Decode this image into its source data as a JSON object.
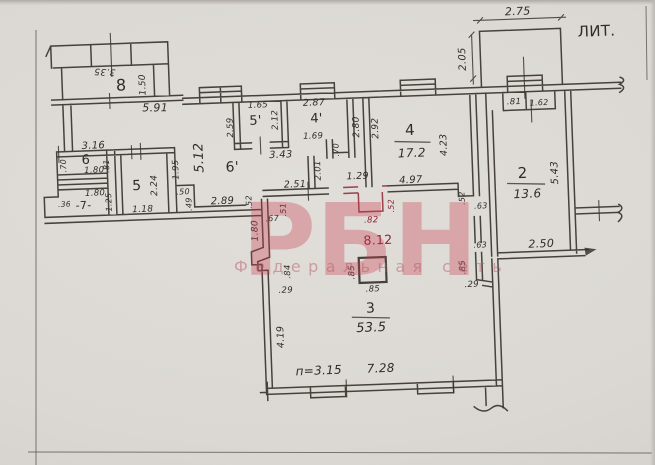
{
  "document": {
    "kind": "scanned floor plan",
    "litera_note": "ЛИТ.",
    "ink_color": "#38342e",
    "paper_color": "#dbd8d3",
    "highlight_color": "#8d2431"
  },
  "watermark": {
    "logo": "РБН",
    "subtitle": "Федеральная сеть",
    "color": "#cb3c4e"
  },
  "labels": {
    "porch_w": "3.35",
    "room8": "8",
    "room8_h": "1.50",
    "wall_591": "5.91",
    "balcony_w": "2.75",
    "balcony_d": "2.05",
    "lit": "ЛИТ.",
    "wall_316": "3.16",
    "room6": "6",
    "room6_l": ".70",
    "room6_w": "1.80",
    "room6_h": ".81",
    "room7_w": "1.80",
    "room7": "-7-",
    "room7_l": ".36",
    "room7_h": "1.25",
    "room5": "5",
    "room5_h": "2.24",
    "room5_w": "1.18",
    "wall_195": "1.95",
    "corr_len": "5.12",
    "corr": "6'",
    "d50": ".50",
    "d49": ".49",
    "d289": "2.89",
    "d52a": ".52",
    "d251": "2.51",
    "d51": ".51",
    "d67": ".67",
    "d180": "1.80",
    "room5p": "5'",
    "room5p_w": "1.65",
    "room5p_h": "2.12",
    "room5p_l": "2.59",
    "d343": "3.43",
    "room4p": "4'",
    "room4p_w": "2.87",
    "room4p_h": "2.80",
    "d169": "1.69",
    "d70": ".70",
    "d201": "2.01",
    "d129": "1.29",
    "room4": "4",
    "room4_area": "17.2",
    "d292": "2.92",
    "d423": "4.23",
    "d497": "4.97",
    "d82": ".82",
    "hall_area": "8.12",
    "d52b": ".52",
    "d52c": ".52",
    "d63a": ".63",
    "d63b": ".63",
    "d85a": ".85",
    "d29a": ".29",
    "r2_81": ".81",
    "r2_162": "1.62",
    "room2": "2",
    "room2_area": "13.6",
    "d543": "5.43",
    "d250": "2.50",
    "d84": ".84",
    "d29b": ".29",
    "d419": "4.19",
    "room3": "3",
    "room3_area": "53.5",
    "col85l": ".85",
    "col85b": ".85",
    "height_note": "п=3.15",
    "d728": "7.28"
  }
}
